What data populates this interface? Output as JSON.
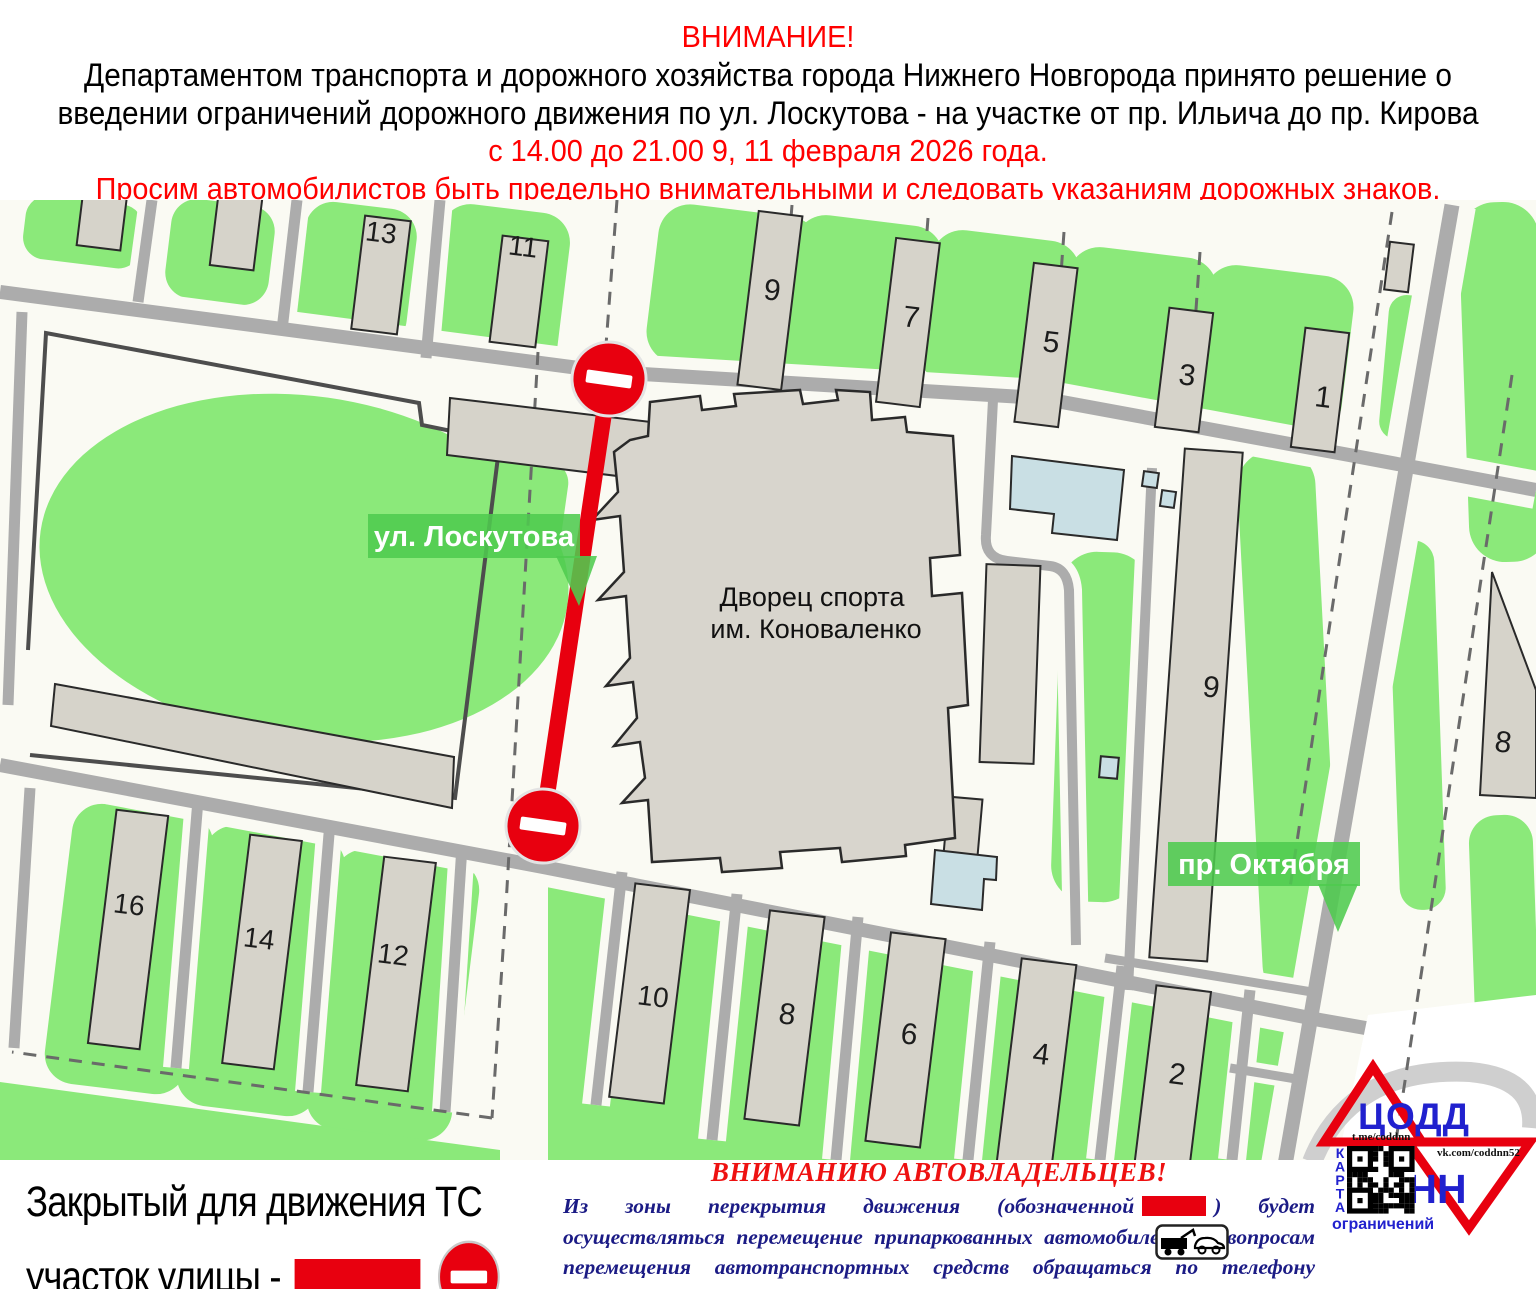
{
  "header": {
    "line1": "ВНИМАНИЕ!",
    "line2": "Департаментом транспорта и дорожного хозяйства города Нижнего Новгорода принято решение о",
    "line3": "введении ограничений дорожного движения по ул. Лоскутова - на участке от пр. Ильича до пр. Кирова",
    "line4": "с 14.00 до 21.00 9, 11 февраля 2026 года.",
    "line5": "Просим автомобилистов быть предельно внимательными и следовать указаниям дорожных знаков."
  },
  "map": {
    "street_labels": [
      {
        "id": "loskutova",
        "text": "ул. Лоскутова"
      },
      {
        "id": "oktyabrya",
        "text": "пр. Октября"
      }
    ],
    "venue": {
      "line1": "Дворец спорта",
      "line2": "им. Коноваленко"
    },
    "building_numbers": [
      {
        "label": "13",
        "x": 380,
        "y": 242
      },
      {
        "label": "11",
        "x": 522,
        "y": 256
      },
      {
        "label": "9",
        "x": 771,
        "y": 300
      },
      {
        "label": "7",
        "x": 910,
        "y": 327
      },
      {
        "label": "5",
        "x": 1050,
        "y": 352
      },
      {
        "label": "3",
        "x": 1186,
        "y": 385
      },
      {
        "label": "1",
        "x": 1322,
        "y": 407
      },
      {
        "label": "9",
        "x": 1210,
        "y": 697
      },
      {
        "label": "8",
        "x": 1502,
        "y": 752
      },
      {
        "label": "16",
        "x": 128,
        "y": 914
      },
      {
        "label": "14",
        "x": 258,
        "y": 948
      },
      {
        "label": "12",
        "x": 392,
        "y": 964
      },
      {
        "label": "10",
        "x": 652,
        "y": 1006
      },
      {
        "label": "8",
        "x": 786,
        "y": 1024
      },
      {
        "label": "6",
        "x": 908,
        "y": 1044
      },
      {
        "label": "4",
        "x": 1040,
        "y": 1064
      },
      {
        "label": "2",
        "x": 1176,
        "y": 1084
      }
    ]
  },
  "legend": {
    "line1": "Закрытый для движения ТС",
    "line2": "участок улицы -"
  },
  "notice": {
    "title": "ВНИМАНИЮ АВТОВЛАДЕЛЬЦЕВ!",
    "body_before": "Из зоны перекрытия движения (обозначенной",
    "body_after": ") будет осуществляться перемещение припаркованных автомобилей. По вопросам перемещения автотранспортных средств обращаться по телефону",
    "phone": "417-17-07"
  },
  "logo": {
    "org": "ЦОДД",
    "city": "НН",
    "telegram": "t.me/coddnn",
    "vk": "vk.com/coddnn52",
    "map_word": "КАРТА",
    "map_word2": "ограничений"
  },
  "colors": {
    "accent_red": "#e8000f",
    "header_red": "#ff0000",
    "map_green": "#8be97a",
    "label_green": "#4fcb4f",
    "road_gray": "#acacac",
    "building_gray": "#d6d3ca",
    "water_blue": "#c9dfe4",
    "map_bg": "#fafaf3",
    "logo_blue": "#2121ce",
    "notice_navy": "#1b1b85"
  }
}
